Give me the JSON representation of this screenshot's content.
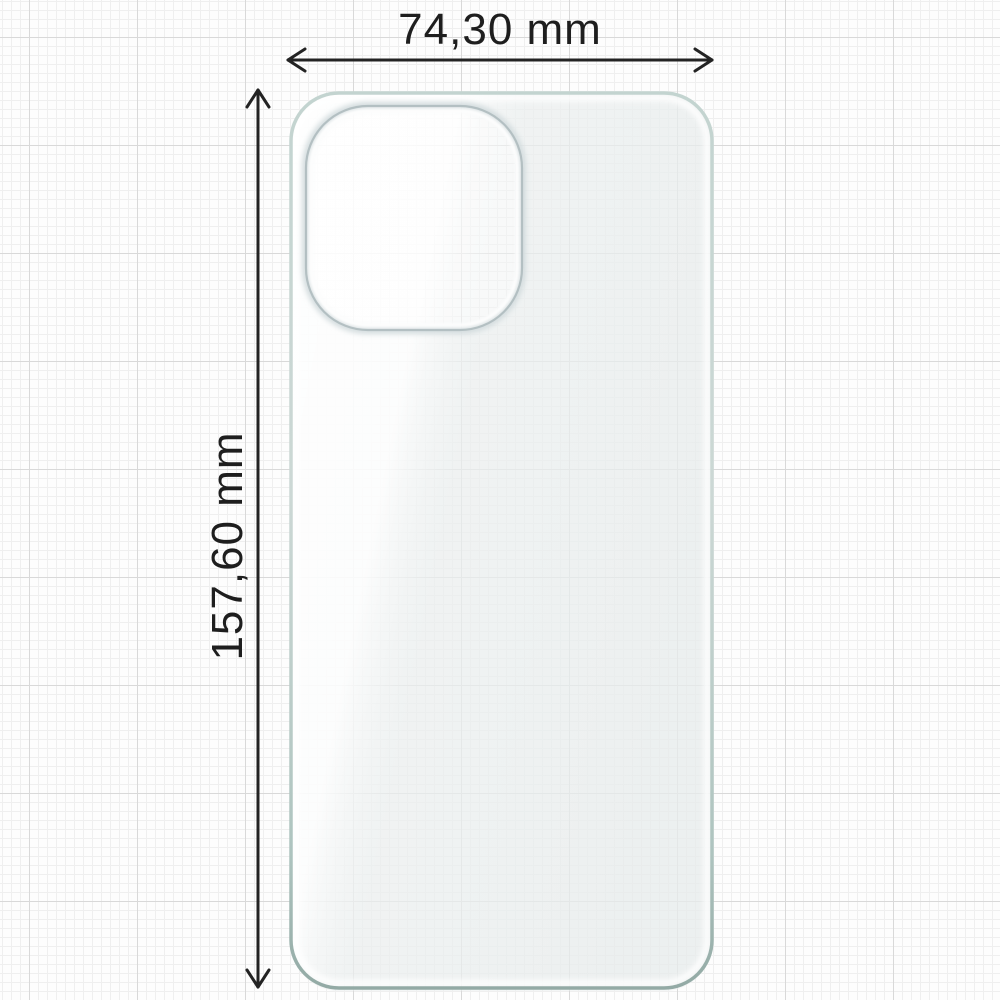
{
  "diagram": {
    "type": "product-dimension-diagram",
    "subject": "transparent phone case back film with camera cutout",
    "dimensions": {
      "width": {
        "label": "74,30 mm",
        "value": 74.3,
        "unit": "mm"
      },
      "height": {
        "label": "157,60 mm",
        "value": 157.6,
        "unit": "mm"
      }
    },
    "colors": {
      "background": "#fdfdfd",
      "grid_minor": "#efefef",
      "grid_major": "#d9d9d9",
      "dimension_line": "#232323",
      "label_text": "#1e1e1e",
      "case_edge_light": "#cfe0dc",
      "case_edge_dark": "#9db4af",
      "case_fill": "#f1f4f4",
      "camera_ring": "#b3bfc2"
    }
  }
}
